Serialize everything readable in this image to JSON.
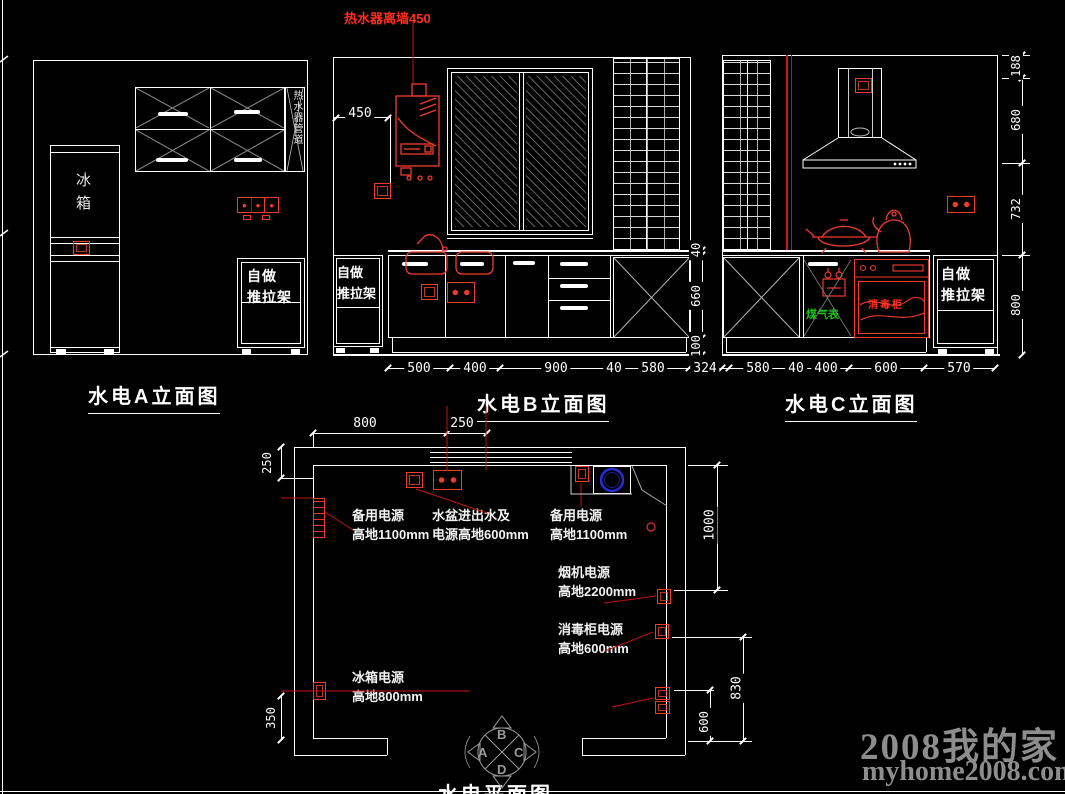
{
  "watermark": {
    "title": "2008我的家",
    "url": "myhome2008.com"
  },
  "colors": {
    "line": "#ffffff",
    "annotation_red": "#f23b2e",
    "leader_red": "#c41212",
    "gas_green": "#17c417",
    "sink_blue": "#2a2ad0",
    "watermark_gray": "#8d8d8d"
  },
  "ev_a": {
    "title": "水电A立面图",
    "fridge": "冰箱",
    "filler": "热水器管道",
    "rack_l1": "自做",
    "rack_l2": "推拉架"
  },
  "ev_b": {
    "title": "水电B立面图",
    "heater_note": "热水器离墙450",
    "dim_450": "450",
    "rack_l1": "自做",
    "rack_l2": "推拉架",
    "dims_bottom": [
      "500",
      "400",
      "900",
      "40",
      "580",
      "324"
    ],
    "dims_right": [
      "40",
      "660",
      "100"
    ]
  },
  "ev_c": {
    "title": "水电C立面图",
    "gas_meter": "煤气表",
    "disinfect": "消毒柜",
    "rack_l1": "自做",
    "rack_l2": "推拉架",
    "dims_bottom": [
      "580",
      "40",
      "400",
      "600",
      "570"
    ],
    "dims_right": [
      "188",
      "680",
      "732",
      "800"
    ]
  },
  "plan": {
    "title": "水电平面图",
    "dims": {
      "top_800": "800",
      "top_250": "250",
      "left_250": "250",
      "left_350": "350",
      "right_1000": "1000",
      "right_830": "830",
      "right_600": "600"
    },
    "notes": {
      "spare1_l1": "备用电源",
      "spare1_l2": "高地1100mm",
      "sink_l1": "水盆进出水及",
      "sink_l2": "电源高地600mm",
      "spare2_l1": "备用电源",
      "spare2_l2": "高地1100mm",
      "hood_l1": "烟机电源",
      "hood_l2": "高地2200mm",
      "disinfect_l1": "消毒柜电源",
      "disinfect_l2": "高地600mm",
      "fridge_l1": "冰箱电源",
      "fridge_l2": "高地800mm"
    },
    "compass": {
      "a": "A",
      "b": "B",
      "c": "C",
      "d": "D"
    }
  }
}
